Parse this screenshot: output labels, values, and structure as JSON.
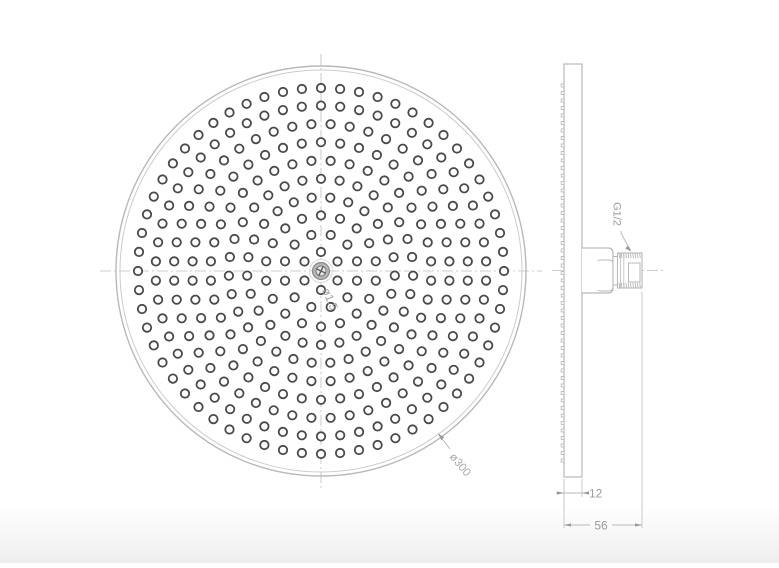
{
  "title": "Overhead rain shower head — technical drawing (front and side views)",
  "colors": {
    "line": "#b9b9b9",
    "line_light": "#c9c9c9",
    "text": "#9c9c9c",
    "hole": "#4a4a4a",
    "hub_fill": "#b5b5b5",
    "hub_inner_fill": "#e6e6e6",
    "background": "#ffffff"
  },
  "front_view": {
    "name": "faceplate front view",
    "labels": {
      "hole_diameter": "ø1.5",
      "outer_diameter": "ø300"
    },
    "center": {
      "x": 321,
      "y": 271
    },
    "outer_radius": 205,
    "inner_radius": 201,
    "hole_radius": 4.2,
    "hole_pattern": {
      "type": "concentric-rings",
      "rings": [
        {
          "r": 19.0,
          "count": 6,
          "offset": -90
        },
        {
          "r": 37.3,
          "count": 12,
          "offset": -75
        },
        {
          "r": 55.6,
          "count": 18,
          "offset": -90
        },
        {
          "r": 73.9,
          "count": 25,
          "offset": -82.8
        },
        {
          "r": 92.2,
          "count": 31,
          "offset": -90
        },
        {
          "r": 110.5,
          "count": 36,
          "offset": -85
        },
        {
          "r": 128.8,
          "count": 42,
          "offset": -90
        },
        {
          "r": 147.1,
          "count": 48,
          "offset": -86.25
        },
        {
          "r": 165.4,
          "count": 54,
          "offset": -90
        },
        {
          "r": 183.0,
          "count": 60,
          "offset": -90
        }
      ]
    }
  },
  "side_view": {
    "name": "side profile view with inlet connector",
    "labels": {
      "thread": "G1/2",
      "thickness": "12",
      "depth": "56"
    },
    "nozzle_bumps": {
      "y_start": 84,
      "y_end": 459,
      "step": 7.5,
      "height": 3
    },
    "thread_hatch": {
      "x_start": 619,
      "x_end": 641,
      "step": 2.3
    }
  }
}
